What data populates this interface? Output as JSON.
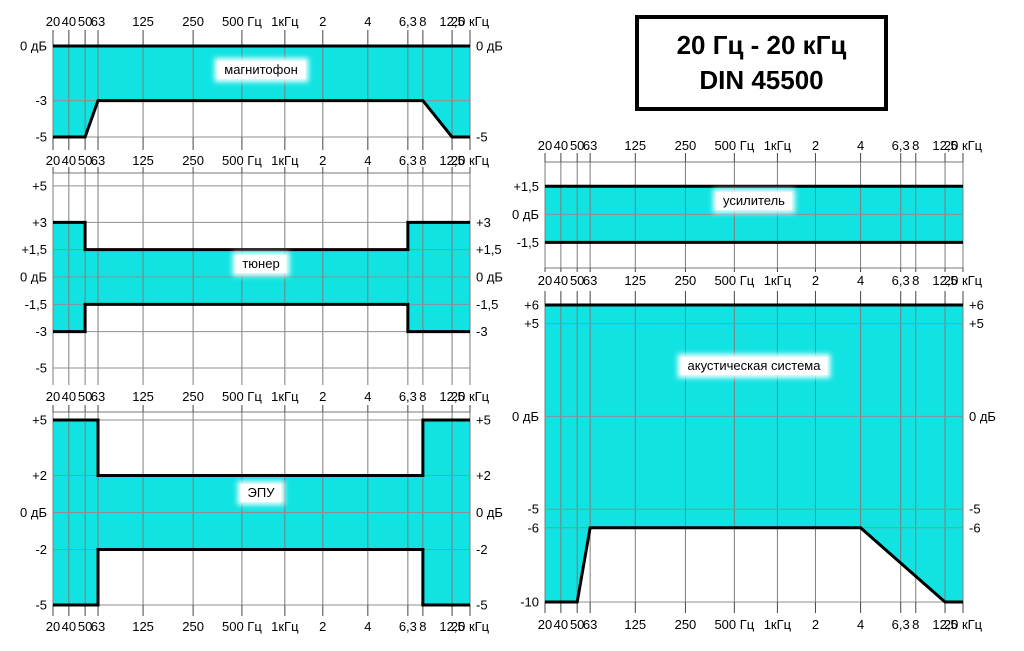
{
  "page": {
    "background_color": "#ffffff"
  },
  "title_box": {
    "line1": "20 Гц - 20 кГц",
    "line2": "DIN 45500"
  },
  "colors": {
    "band_fill": "#11e3e3",
    "mask_line": "#000000",
    "grid_vertical": "#7d7d7d",
    "grid_horizontal": "#8f8f8f",
    "tick": "#444444",
    "text": "#000000"
  },
  "x_axis": {
    "tick_labels": [
      "20",
      "40",
      "50",
      "63",
      "125",
      "250",
      "500 Гц",
      "1кГц",
      "2",
      "4",
      "6,3",
      "8",
      "12,5",
      "20 кГц"
    ],
    "tick_freqs_hz": [
      20,
      40,
      50,
      63,
      125,
      250,
      500,
      1000,
      2000,
      4000,
      6300,
      8000,
      12500,
      20000
    ]
  },
  "chart_data": [
    {
      "id": "magnitofon",
      "type": "area",
      "title": "магнитофон",
      "ylim": [
        0,
        -5
      ],
      "upper_limit_db": [
        [
          20,
          0
        ],
        [
          20000,
          0
        ]
      ],
      "lower_limit_db": [
        [
          20,
          -5
        ],
        [
          50,
          -5
        ],
        [
          63,
          -3
        ],
        [
          8000,
          -3
        ],
        [
          12500,
          -5
        ],
        [
          20000,
          -5
        ]
      ],
      "y_labels_left": [
        {
          "db": 0,
          "label": "0 дБ"
        },
        {
          "db": -3,
          "label": "-3"
        },
        {
          "db": -5,
          "label": "-5"
        }
      ],
      "y_labels_right": [
        {
          "db": 0,
          "label": "0 дБ"
        },
        {
          "db": -5,
          "label": "-5"
        }
      ]
    },
    {
      "id": "tuner",
      "type": "area",
      "title": "тюнер",
      "ylim": [
        5.71,
        -5.93
      ],
      "upper_limit_db": [
        [
          20,
          3
        ],
        [
          50,
          3
        ],
        [
          50,
          1.5
        ],
        [
          6300,
          1.5
        ],
        [
          6300,
          3
        ],
        [
          20000,
          3
        ]
      ],
      "lower_limit_db": [
        [
          20,
          -3
        ],
        [
          50,
          -3
        ],
        [
          50,
          -1.5
        ],
        [
          6300,
          -1.5
        ],
        [
          6300,
          -3
        ],
        [
          20000,
          -3
        ]
      ],
      "y_labels_left": [
        {
          "db": 5,
          "label": "+5"
        },
        {
          "db": 3,
          "label": "+3"
        },
        {
          "db": 1.5,
          "label": "+1,5"
        },
        {
          "db": 0,
          "label": "0 дБ"
        },
        {
          "db": -1.5,
          "label": "-1,5"
        },
        {
          "db": -3,
          "label": "-3"
        },
        {
          "db": -5,
          "label": "-5"
        }
      ],
      "y_labels_right": [
        {
          "db": 3,
          "label": "+3"
        },
        {
          "db": 1.5,
          "label": "+1,5"
        },
        {
          "db": 0,
          "label": "0 дБ"
        },
        {
          "db": -1.5,
          "label": "-1,5"
        },
        {
          "db": -3,
          "label": "-3"
        }
      ]
    },
    {
      "id": "epu",
      "type": "area",
      "title": "ЭПУ",
      "ylim": [
        5.43,
        -5
      ],
      "upper_limit_db": [
        [
          20,
          5
        ],
        [
          63,
          5
        ],
        [
          63,
          2
        ],
        [
          8000,
          2
        ],
        [
          8000,
          5
        ],
        [
          20000,
          5
        ]
      ],
      "lower_limit_db": [
        [
          20,
          -5
        ],
        [
          63,
          -5
        ],
        [
          63,
          -2
        ],
        [
          8000,
          -2
        ],
        [
          8000,
          -5
        ],
        [
          20000,
          -5
        ]
      ],
      "y_labels_left": [
        {
          "db": 5,
          "label": "+5"
        },
        {
          "db": 2,
          "label": "+2"
        },
        {
          "db": 0,
          "label": "0 дБ"
        },
        {
          "db": -2,
          "label": "-2"
        },
        {
          "db": -5,
          "label": "-5"
        }
      ],
      "y_labels_right": [
        {
          "db": 5,
          "label": "+5"
        },
        {
          "db": 2,
          "label": "+2"
        },
        {
          "db": 0,
          "label": "0 дБ"
        },
        {
          "db": -2,
          "label": "-2"
        },
        {
          "db": -5,
          "label": "-5"
        }
      ]
    },
    {
      "id": "usilitel",
      "type": "area",
      "title": "усилитель",
      "ylim": [
        2.8,
        -2.87
      ],
      "upper_limit_db": [
        [
          20,
          1.5
        ],
        [
          20000,
          1.5
        ]
      ],
      "lower_limit_db": [
        [
          20,
          -1.5
        ],
        [
          20000,
          -1.5
        ]
      ],
      "y_labels_left": [
        {
          "db": 1.5,
          "label": "+1,5"
        },
        {
          "db": 0,
          "label": "0 дБ"
        },
        {
          "db": -1.5,
          "label": "-1,5"
        }
      ],
      "y_labels_right": []
    },
    {
      "id": "akustika",
      "type": "area",
      "title": "акустическая система",
      "ylim": [
        6,
        -10
      ],
      "upper_limit_db": [
        [
          20,
          6
        ],
        [
          20000,
          6
        ]
      ],
      "lower_limit_db": [
        [
          20,
          -10
        ],
        [
          50,
          -10
        ],
        [
          63,
          -6
        ],
        [
          4000,
          -6
        ],
        [
          12500,
          -10
        ],
        [
          20000,
          -10
        ]
      ],
      "y_labels_left": [
        {
          "db": 6,
          "label": "+6"
        },
        {
          "db": 5,
          "label": "+5"
        },
        {
          "db": 0,
          "label": "0 дБ"
        },
        {
          "db": -5,
          "label": "-5"
        },
        {
          "db": -6,
          "label": "-6"
        },
        {
          "db": -10,
          "label": "-10"
        }
      ],
      "y_labels_right": [
        {
          "db": 6,
          "label": "+6"
        },
        {
          "db": 5,
          "label": "+5"
        },
        {
          "db": 0,
          "label": "0 дБ"
        },
        {
          "db": -5,
          "label": "-5"
        },
        {
          "db": -6,
          "label": "-6"
        }
      ]
    }
  ]
}
